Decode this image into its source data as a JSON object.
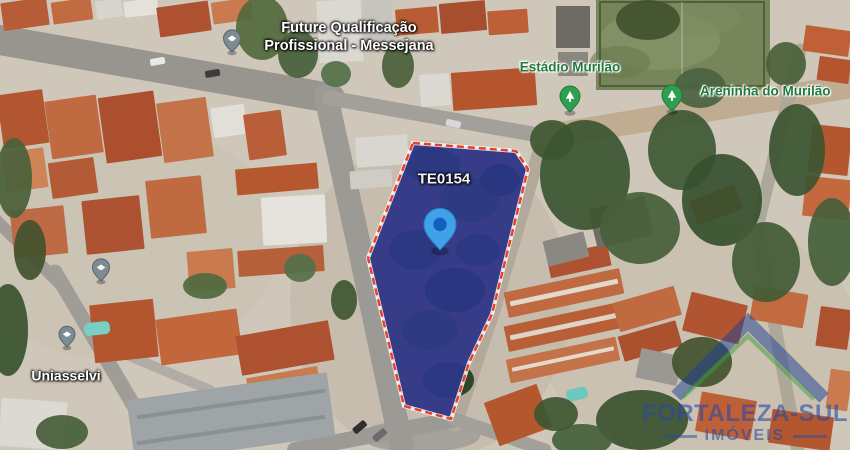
{
  "map": {
    "width": 850,
    "height": 450,
    "base_color": "#cfc7ba",
    "lot": {
      "points": "413,143 516,151 528,169 492,314 469,363 451,419 404,406 368,258",
      "ground_fill": "#4a4f38",
      "overlay_fill": "rgba(44,48,190,0.6)",
      "outline_color": "#e8402a",
      "outline_underlay": "rgba(255,255,255,0.85)"
    },
    "labels": [
      {
        "id": "label-future-qualificacao",
        "lines": [
          "Future Qualificação",
          "Profissional - Messejana"
        ],
        "x": 349,
        "y": 37,
        "color": "#ffffff",
        "halo": "dark",
        "size": 14.5,
        "align": "center"
      },
      {
        "id": "label-estadio-murilao",
        "lines": [
          "Estádio Murilão"
        ],
        "x": 570,
        "y": 68,
        "color": "#227a3c",
        "halo": "light",
        "size": 13.5,
        "align": "center"
      },
      {
        "id": "label-areninha-do-murilao",
        "lines": [
          "Areninha do Murilão"
        ],
        "x": 700,
        "y": 92,
        "color": "#227a3c",
        "halo": "light",
        "size": 13.5,
        "align": "left"
      },
      {
        "id": "label-lot-code",
        "lines": [
          "TE0154"
        ],
        "x": 444,
        "y": 180,
        "color": "#f4f4f4",
        "halo": "dark",
        "size": 15,
        "align": "center"
      },
      {
        "id": "label-uniasselvi",
        "lines": [
          "Uniasselvi"
        ],
        "x": 66,
        "y": 376,
        "color": "#ffffff",
        "halo": "dark",
        "size": 14,
        "align": "center"
      }
    ],
    "pins": [
      {
        "id": "pin-education-messejana",
        "icon": "education",
        "x": 232,
        "y": 52,
        "r": 8.5,
        "fill": "#7d8b95",
        "stroke": "#56636c",
        "icon_color": "#ffffff"
      },
      {
        "id": "pin-poi-left",
        "icon": "education",
        "x": 101,
        "y": 281,
        "r": 8.5,
        "fill": "#7d8b95",
        "stroke": "#56636c",
        "icon_color": "#fff6e0"
      },
      {
        "id": "pin-uniasselvi",
        "icon": "education",
        "x": 67,
        "y": 347,
        "r": 8,
        "fill": "#7d8b95",
        "stroke": "#56636c",
        "icon_color": "#ffffff"
      },
      {
        "id": "pin-estadio-murilao",
        "icon": "park",
        "x": 570,
        "y": 112,
        "r": 10,
        "fill": "#2f9e4f",
        "stroke": "#1d7a3a",
        "icon_color": "#ffffff"
      },
      {
        "id": "pin-areninha-do-murilao",
        "icon": "park",
        "x": 672,
        "y": 111,
        "r": 10,
        "fill": "#2f9e4f",
        "stroke": "#1d7a3a",
        "icon_color": "#ffffff"
      },
      {
        "id": "pin-property-te0154",
        "icon": "property",
        "x": 440,
        "y": 250,
        "r": 16,
        "fill": "#3fa1e8",
        "stroke": "#2b7fc4",
        "inner": "#1460c0"
      }
    ],
    "field": {
      "x": 596,
      "y": 0,
      "w": 174,
      "h": 90,
      "fill": "#76865a",
      "border": "#49552f",
      "line_color": "rgba(255,255,255,0.28)"
    },
    "roads": [
      {
        "p": [
          [
            0,
            40
          ],
          [
            330,
            98
          ]
        ],
        "w": 30,
        "c": "#98958e"
      },
      {
        "p": [
          [
            326,
            96
          ],
          [
            360,
            250
          ],
          [
            402,
            448
          ]
        ],
        "w": 24,
        "c": "#9c9a94"
      },
      {
        "p": [
          [
            330,
            98
          ],
          [
            555,
            138
          ]
        ],
        "w": 15,
        "c": "#a3a099"
      },
      {
        "p": [
          [
            548,
            136
          ],
          [
            852,
            86
          ]
        ],
        "w": 24,
        "c": "#bfac91"
      },
      {
        "p": [
          [
            540,
            150
          ],
          [
            492,
            315
          ],
          [
            455,
            425
          ]
        ],
        "w": 14,
        "c": "#b2a99b"
      },
      {
        "p": [
          [
            452,
            420
          ],
          [
            295,
            450
          ]
        ],
        "w": 16,
        "c": "#9c9a94"
      },
      {
        "p": [
          [
            452,
            418
          ],
          [
            545,
            450
          ]
        ],
        "w": 13,
        "c": "#a3a09a"
      },
      {
        "p": [
          [
            55,
            272
          ],
          [
            160,
            450
          ]
        ],
        "w": 15,
        "c": "#a09d97"
      },
      {
        "p": [
          [
            120,
            352
          ],
          [
            210,
            390
          ]
        ],
        "w": 10,
        "c": "#b0ada6"
      },
      {
        "p": [
          [
            -4,
            220
          ],
          [
            60,
            284
          ]
        ],
        "w": 12,
        "c": "#a09d97"
      },
      {
        "p": [
          [
            800,
            50
          ],
          [
            757,
            228
          ],
          [
            798,
            452
          ]
        ],
        "w": 13,
        "c": "#ada999"
      }
    ],
    "ground_patches": [
      [
        120,
        240,
        160,
        120,
        "#c8bfae",
        0.5
      ],
      [
        430,
        300,
        140,
        160,
        "#b8b0a0",
        0.4
      ],
      [
        700,
        340,
        160,
        120,
        "#c2b8a6",
        0.4
      ],
      [
        420,
        436,
        60,
        16,
        "#a5a29b",
        1
      ]
    ],
    "buildings": [
      [
        2,
        0,
        46,
        28,
        -8,
        "#b65c36"
      ],
      [
        52,
        0,
        40,
        22,
        -8,
        "#c26a40"
      ],
      [
        96,
        0,
        26,
        18,
        -8,
        "#d8d5cf"
      ],
      [
        124,
        0,
        34,
        16,
        -6,
        "#e4e1da"
      ],
      [
        158,
        4,
        52,
        30,
        -8,
        "#ad5130"
      ],
      [
        212,
        0,
        40,
        22,
        -8,
        "#c97a4e"
      ],
      [
        318,
        0,
        44,
        62,
        -3,
        "#dbd8d2"
      ],
      [
        364,
        0,
        28,
        40,
        -3,
        "#c7c4be"
      ],
      [
        396,
        8,
        42,
        26,
        -5,
        "#b85c35"
      ],
      [
        440,
        2,
        46,
        30,
        -5,
        "#a64e2d"
      ],
      [
        488,
        10,
        40,
        24,
        -4,
        "#bd6038"
      ],
      [
        556,
        6,
        34,
        42,
        0,
        "#6e6a64"
      ],
      [
        558,
        52,
        30,
        24,
        0,
        "#8a8680"
      ],
      [
        804,
        28,
        46,
        26,
        8,
        "#c06038"
      ],
      [
        818,
        58,
        32,
        24,
        8,
        "#b5552f"
      ],
      [
        0,
        92,
        46,
        54,
        -8,
        "#b25531"
      ],
      [
        48,
        98,
        52,
        58,
        -8,
        "#c06a42"
      ],
      [
        102,
        94,
        56,
        66,
        -8,
        "#ab4f2e"
      ],
      [
        160,
        100,
        50,
        60,
        -8,
        "#c4724a"
      ],
      [
        4,
        150,
        42,
        40,
        -8,
        "#cf8457"
      ],
      [
        50,
        160,
        46,
        36,
        -8,
        "#b25b36"
      ],
      [
        212,
        106,
        34,
        30,
        -8,
        "#e2dfd8"
      ],
      [
        246,
        112,
        38,
        46,
        -8,
        "#b95e39"
      ],
      [
        236,
        166,
        82,
        26,
        -5,
        "#b5582f"
      ],
      [
        262,
        196,
        64,
        48,
        -3,
        "#e6e3de"
      ],
      [
        238,
        248,
        86,
        26,
        -4,
        "#b5603a"
      ],
      [
        148,
        178,
        56,
        58,
        -6,
        "#c06a42"
      ],
      [
        84,
        198,
        58,
        54,
        -6,
        "#ad5233"
      ],
      [
        12,
        208,
        54,
        48,
        -6,
        "#bd6a45"
      ],
      [
        188,
        250,
        46,
        40,
        -5,
        "#c97a4e"
      ],
      [
        356,
        136,
        52,
        30,
        -4,
        "#d9d6d0"
      ],
      [
        350,
        170,
        42,
        18,
        -4,
        "#ceccc5"
      ],
      [
        452,
        70,
        84,
        38,
        -4,
        "#b4552e"
      ],
      [
        420,
        74,
        30,
        32,
        -4,
        "#dcd9d3"
      ],
      [
        92,
        302,
        64,
        58,
        -6,
        "#b35630"
      ],
      [
        158,
        314,
        82,
        46,
        -8,
        "#c2663c"
      ],
      [
        238,
        328,
        94,
        40,
        -10,
        "#ad5130"
      ],
      [
        248,
        372,
        72,
        28,
        -10,
        "#c97a4e"
      ],
      [
        0,
        400,
        66,
        48,
        4,
        "#dcd8d2"
      ],
      [
        130,
        386,
        202,
        64,
        -8,
        "#9fa4a7"
      ],
      [
        136,
        402,
        190,
        4,
        -8,
        "#8b9095"
      ],
      [
        136,
        428,
        190,
        4,
        -8,
        "#8b9095"
      ],
      [
        490,
        392,
        56,
        46,
        -20,
        "#b5572e"
      ],
      [
        505,
        280,
        118,
        26,
        -12,
        "#c06a42"
      ],
      [
        505,
        314,
        118,
        26,
        -12,
        "#b85f38"
      ],
      [
        507,
        348,
        112,
        24,
        -12,
        "#c4724a"
      ],
      [
        509,
        290,
        110,
        5,
        -12,
        "#e3d9cb"
      ],
      [
        509,
        324,
        110,
        5,
        -12,
        "#ded3c4"
      ],
      [
        511,
        357,
        104,
        4,
        -12,
        "#e3d9cb"
      ],
      [
        548,
        250,
        62,
        22,
        -12,
        "#ad5130"
      ],
      [
        615,
        294,
        64,
        30,
        -16,
        "#c06a42"
      ],
      [
        620,
        328,
        60,
        26,
        -16,
        "#ab512e"
      ],
      [
        592,
        202,
        58,
        40,
        -14,
        "#6f6c66"
      ],
      [
        692,
        192,
        48,
        26,
        -20,
        "#b95e35"
      ],
      [
        545,
        236,
        42,
        26,
        -14,
        "#8b8782"
      ],
      [
        810,
        126,
        40,
        48,
        6,
        "#b5572e"
      ],
      [
        804,
        178,
        46,
        40,
        6,
        "#c4683e"
      ],
      [
        686,
        298,
        58,
        40,
        14,
        "#b05431"
      ],
      [
        752,
        290,
        54,
        34,
        10,
        "#c26a40"
      ],
      [
        818,
        308,
        32,
        40,
        8,
        "#ad5130"
      ],
      [
        698,
        396,
        56,
        40,
        10,
        "#bd6038"
      ],
      [
        770,
        413,
        62,
        34,
        8,
        "#b5572e"
      ],
      [
        828,
        370,
        22,
        40,
        8,
        "#c97a4e"
      ],
      [
        638,
        352,
        42,
        30,
        12,
        "#9b9894"
      ],
      [
        84,
        322,
        26,
        13,
        -6,
        "#79cfc4",
        5
      ],
      [
        566,
        388,
        22,
        12,
        -12,
        "#6fc8c0",
        5
      ]
    ],
    "trees": [
      [
        262,
        28,
        26,
        32,
        "#52693c"
      ],
      [
        298,
        54,
        20,
        24,
        "#47603a"
      ],
      [
        336,
        74,
        15,
        13,
        "#55704a"
      ],
      [
        398,
        66,
        16,
        22,
        "#4a6138"
      ],
      [
        552,
        140,
        22,
        20,
        "#3f5631"
      ],
      [
        648,
        20,
        32,
        20,
        "#42532f"
      ],
      [
        585,
        175,
        45,
        55,
        "#3c5531"
      ],
      [
        640,
        228,
        40,
        36,
        "#46603a"
      ],
      [
        682,
        150,
        34,
        40,
        "#3f5834"
      ],
      [
        722,
        200,
        40,
        46,
        "#36502e"
      ],
      [
        766,
        262,
        34,
        40,
        "#425b36"
      ],
      [
        797,
        150,
        28,
        46,
        "#3c5531"
      ],
      [
        832,
        242,
        24,
        44,
        "#46603a"
      ],
      [
        700,
        88,
        26,
        20,
        "#4a6340"
      ],
      [
        786,
        64,
        20,
        22,
        "#4a6138"
      ],
      [
        642,
        420,
        46,
        30,
        "#3a5230"
      ],
      [
        582,
        440,
        30,
        16,
        "#46603a"
      ],
      [
        702,
        362,
        30,
        25,
        "#42532f"
      ],
      [
        556,
        414,
        22,
        17,
        "#3f5631"
      ],
      [
        14,
        178,
        18,
        40,
        "#4a6138"
      ],
      [
        30,
        250,
        16,
        30,
        "#42532f"
      ],
      [
        8,
        330,
        20,
        46,
        "#3a5230"
      ],
      [
        62,
        432,
        26,
        17,
        "#46603a"
      ],
      [
        205,
        286,
        22,
        13,
        "#4e6a3e"
      ],
      [
        344,
        300,
        13,
        20,
        "#3f5631"
      ],
      [
        300,
        268,
        16,
        14,
        "#55704a"
      ]
    ],
    "lot_trees": [
      [
        432,
        165,
        28,
        18,
        "#2e4528"
      ],
      [
        470,
        200,
        30,
        22,
        "#32492a"
      ],
      [
        415,
        250,
        26,
        20,
        "#2e4528"
      ],
      [
        455,
        290,
        30,
        22,
        "#2a4125"
      ],
      [
        430,
        330,
        28,
        20,
        "#32492a"
      ],
      [
        448,
        380,
        26,
        18,
        "#2e4528"
      ],
      [
        500,
        180,
        20,
        16,
        "#2a4125"
      ],
      [
        478,
        250,
        22,
        16,
        "#2e4528"
      ]
    ],
    "cars": [
      [
        150,
        58,
        -10,
        "#e8e8e8"
      ],
      [
        205,
        70,
        -10,
        "#3c3c3c"
      ],
      [
        352,
        424,
        -40,
        "#2f2f2f"
      ],
      [
        372,
        432,
        -40,
        "#6a6a6a"
      ],
      [
        446,
        120,
        12,
        "#d8d8d8"
      ]
    ]
  },
  "watermark": {
    "title": "FORTALEZA-SUL",
    "subtitle": "IMÓVEIS",
    "roof_color": "#1c3e96",
    "accent_color": "#3f9b42"
  }
}
